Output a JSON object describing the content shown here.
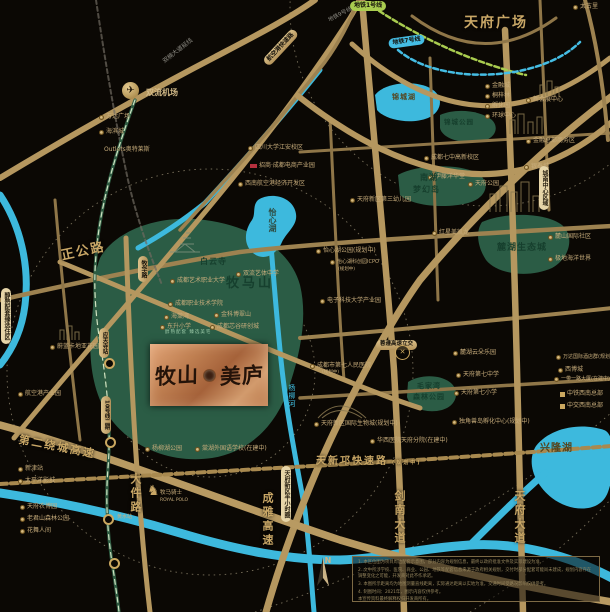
{
  "project": {
    "name_left": "牧山",
    "name_right": "美庐",
    "slogan": "醇熟配套 臻选美宅"
  },
  "colors": {
    "background": "#0b0804",
    "road_gold": "#b5975f",
    "water_cyan": "#3db9dd",
    "park_green": "#2b5c45",
    "plaque_copper": "#c08052",
    "accent_gold": "#c9a766"
  },
  "compass": {
    "letter": "N"
  },
  "disclaimer": {
    "lines": [
      "1. 本区位图为项目周边配套示意图，部分内容为规划信息，最终以政府批准文件及实际建设为准。",
      "2. 文中所涉学校、医院、商业、公园、地铁等配套信息来源于政府相关规划，交付时部分配套可能尚未建成，规划内容存在调整变化之可能，开发商对此不作承诺。",
      "3. 本图所示距离均为地图测量直线距离，实际通达距离以实地为准，交通时间受路况影响仅供参考。",
      "4. 制图时间：2021年，图示内容仅供参考。",
      "本宣传资料最终解释权归开发商所有。"
    ]
  },
  "map": {
    "labels": [
      {
        "t": "双流机场",
        "x": 146,
        "y": 89,
        "c": "p2",
        "fs": 8,
        "i": "n",
        "n": "label-shuangliu-airport"
      },
      {
        "t": "万达广场",
        "x": 99,
        "y": 114
      },
      {
        "t": "海滨城",
        "x": 99,
        "y": 129
      },
      {
        "t": "Outlets奥特莱斯",
        "x": 104,
        "y": 147,
        "i": "n"
      },
      {
        "t": "四川大学江安校区",
        "x": 248,
        "y": 145
      },
      {
        "t": "招商·成都电商产业园",
        "x": 250,
        "y": 163,
        "i": "r"
      },
      {
        "t": "西南航空港经济开发区",
        "x": 238,
        "y": 181
      },
      {
        "t": "成都七中高新校区",
        "x": 424,
        "y": 155
      },
      {
        "t": "伊藤洋华堂",
        "x": 428,
        "y": 174
      },
      {
        "t": "天府新区第三幼儿园",
        "x": 350,
        "y": 197
      },
      {
        "t": "天府公园",
        "x": 468,
        "y": 181
      },
      {
        "t": "金融城",
        "x": 485,
        "y": 83
      },
      {
        "t": "桐梓林",
        "x": 485,
        "y": 93
      },
      {
        "t": "孵化园",
        "x": 485,
        "y": 103
      },
      {
        "t": "环球中心",
        "x": 485,
        "y": 113
      },
      {
        "t": "新会展中心",
        "x": 526,
        "y": 97
      },
      {
        "t": "金融总部商务区",
        "x": 526,
        "y": 138
      },
      {
        "t": "银泰城",
        "x": 524,
        "y": 164
      },
      {
        "t": "麓山国际社区",
        "x": 548,
        "y": 234
      },
      {
        "t": "极地海洋世界",
        "x": 548,
        "y": 256
      },
      {
        "t": "红星美凯龙",
        "x": 432,
        "y": 230
      },
      {
        "t": "怡心湖公园(规划中)",
        "x": 316,
        "y": 248
      },
      {
        "t": "怡心湖科创园ICPO",
        "x": 330,
        "y": 260,
        "fs": 5
      },
      {
        "t": "(规划中)",
        "x": 338,
        "y": 268,
        "fs": 4.5,
        "i": "n"
      },
      {
        "t": "电子科技大学产业园",
        "x": 320,
        "y": 298
      },
      {
        "t": "成都市第七人民医院",
        "x": 310,
        "y": 363
      },
      {
        "t": "(规划中)",
        "x": 322,
        "y": 371,
        "fs": 4.5,
        "i": "n"
      },
      {
        "t": "麓湖云朵乐园",
        "x": 453,
        "y": 350
      },
      {
        "t": "天府第七中学",
        "x": 456,
        "y": 372
      },
      {
        "t": "天府第七小学",
        "x": 454,
        "y": 390
      },
      {
        "t": "独角兽岛孵化中心(规划中)",
        "x": 452,
        "y": 419
      },
      {
        "t": "天府新区国际生物城(规划中)",
        "x": 314,
        "y": 421
      },
      {
        "t": "华西医院天府分院(在建中)",
        "x": 370,
        "y": 438
      },
      {
        "t": "万达国际酒店群(规划中)",
        "x": 556,
        "y": 355,
        "fs": 5
      },
      {
        "t": "西博城",
        "x": 558,
        "y": 367
      },
      {
        "t": "一带一路大厦(在建中)",
        "x": 554,
        "y": 377,
        "fs": 5
      },
      {
        "t": "中铁西南总部",
        "x": 560,
        "y": 391,
        "i": "s"
      },
      {
        "t": "中交西南总部",
        "x": 560,
        "y": 403,
        "i": "s"
      },
      {
        "t": "新津站",
        "x": 18,
        "y": 466
      },
      {
        "t": "太平洋影城",
        "x": 18,
        "y": 478
      },
      {
        "t": "天府农博园",
        "x": 20,
        "y": 504
      },
      {
        "t": "老君山森林公园",
        "x": 20,
        "y": 516
      },
      {
        "t": "花舞人间",
        "x": 20,
        "y": 528
      },
      {
        "t": "蔚蓝卡地亚花园城",
        "x": 50,
        "y": 344
      },
      {
        "t": "航空港产业园",
        "x": 18,
        "y": 391
      },
      {
        "t": "成都艺术职业大学",
        "x": 170,
        "y": 278
      },
      {
        "t": "成都职业技术学院",
        "x": 168,
        "y": 301
      },
      {
        "t": "海棠湾",
        "x": 164,
        "y": 314
      },
      {
        "t": "东升小学",
        "x": 160,
        "y": 324
      },
      {
        "t": "金科博翠山",
        "x": 214,
        "y": 312
      },
      {
        "t": "成都芯谷研创城",
        "x": 210,
        "y": 324
      },
      {
        "t": "双流艺体中学",
        "x": 236,
        "y": 271
      },
      {
        "t": "杨柳湖公园",
        "x": 145,
        "y": 446
      },
      {
        "t": "棠湖外国语学校(在建中)",
        "x": 195,
        "y": 446
      },
      {
        "t": "太古里",
        "x": 573,
        "y": 4
      },
      {
        "t": "黄水站",
        "x": 117,
        "y": 515,
        "fs": 5,
        "i": "n"
      },
      {
        "t": "牧马骑士",
        "x": 160,
        "y": 491,
        "fs": 5.5,
        "i": "n"
      },
      {
        "t": "ROYAL POLO",
        "x": 160,
        "y": 499,
        "fs": 4.5,
        "i": "n"
      },
      {
        "t": "天府广场",
        "x": 464,
        "y": 16,
        "c": "rl",
        "fs": 14,
        "n": "label-tianfu-square"
      },
      {
        "t": "正公路",
        "x": 60,
        "y": 250,
        "c": "rl",
        "fs": 13,
        "r": -12,
        "n": "label-zhenggong-road"
      },
      {
        "t": "第二绕城高速",
        "x": 20,
        "y": 434,
        "c": "rl",
        "fs": 11,
        "r": 11
      },
      {
        "t": "大件路",
        "x": 130,
        "y": 473,
        "c": "rv",
        "fs": 11
      },
      {
        "t": "成雅高速",
        "x": 262,
        "y": 492,
        "c": "rv",
        "fs": 11
      },
      {
        "t": "剑南大道",
        "x": 394,
        "y": 490,
        "c": "rv",
        "fs": 11
      },
      {
        "t": "天府大道",
        "x": 514,
        "y": 490,
        "c": "rv",
        "fs": 11
      },
      {
        "t": "天新邛快速路",
        "x": 316,
        "y": 457,
        "c": "rl",
        "fs": 10
      },
      {
        "t": "(规划中)",
        "x": 392,
        "y": 461,
        "c": "rl",
        "fs": 5
      },
      {
        "t": "牧马山",
        "x": 226,
        "y": 277,
        "c": "al",
        "fs": 13,
        "n": "label-muma-mountain"
      },
      {
        "t": "白云寺",
        "x": 200,
        "y": 258,
        "c": "am",
        "fs": 8
      },
      {
        "t": "麓湖生态城",
        "x": 497,
        "y": 244,
        "c": "am",
        "fs": 9
      },
      {
        "t": "南湖",
        "x": 420,
        "y": 174,
        "c": "am",
        "fs": 8
      },
      {
        "t": "梦幻岛",
        "x": 413,
        "y": 186,
        "c": "am",
        "fs": 8
      },
      {
        "t": "毛家湾",
        "x": 417,
        "y": 383,
        "c": "am",
        "fs": 7
      },
      {
        "t": "森林公园",
        "x": 413,
        "y": 394,
        "c": "am",
        "fs": 7
      },
      {
        "t": "锦城公园",
        "x": 444,
        "y": 119,
        "c": "am",
        "fs": 6.5
      },
      {
        "t": "锦城湖",
        "x": 392,
        "y": 94,
        "c": "w",
        "fs": 7
      },
      {
        "t": "怡心湖",
        "x": 268,
        "y": 208,
        "c": "wv2",
        "fs": 8
      },
      {
        "t": "兴隆湖",
        "x": 540,
        "y": 444,
        "c": "w",
        "fs": 10,
        "n": "label-xinglong-lake"
      },
      {
        "t": "杨柳河",
        "x": 288,
        "y": 384,
        "c": "wv",
        "fs": 7
      },
      {
        "t": "地铁1号线",
        "x": 350,
        "y": 1,
        "c": "pg",
        "n": "pill-metro-line1"
      },
      {
        "t": "地铁7号线",
        "x": 388,
        "y": 39,
        "c": "pc",
        "r": -8,
        "n": "pill-metro-line7"
      },
      {
        "t": "地铁9号线",
        "x": 328,
        "y": 19,
        "c": "g",
        "r": -28,
        "fs": 5.5
      },
      {
        "t": "双楠大道延线",
        "x": 162,
        "y": 60,
        "c": "g",
        "r": -38,
        "fs": 6
      },
      {
        "t": "航空港快速路",
        "x": 262,
        "y": 60,
        "c": "ph",
        "r": -47,
        "fs": 6
      },
      {
        "t": "牧华路",
        "x": 138,
        "y": 256,
        "c": "pv",
        "fs": 6
      },
      {
        "t": "应天寺站",
        "x": 99,
        "y": 328,
        "c": "pv",
        "fs": 5.5
      },
      {
        "t": "10号线二期",
        "x": 101,
        "y": 396,
        "c": "pv",
        "fs": 5.5
      },
      {
        "t": "蓉遵高速立交",
        "x": 376,
        "y": 340,
        "c": "ph",
        "fs": 5.5
      },
      {
        "t": "醇熟配套臻选住区",
        "x": 1,
        "y": 288,
        "c": "pk",
        "fs": 6
      },
      {
        "t": "天府新区半小时圈",
        "x": 281,
        "y": 466,
        "c": "pk",
        "fs": 6
      },
      {
        "t": "城南中心区域",
        "x": 539,
        "y": 166,
        "c": "pk",
        "fs": 6
      },
      {
        "t": "醇熟配套 臻选美宅",
        "x": 165,
        "y": 331,
        "c": "gn",
        "fs": 4.5
      }
    ],
    "icons": [
      {
        "k": "plane",
        "x": 122,
        "y": 82,
        "n": "airplane-icon"
      },
      {
        "k": "horse",
        "x": 147,
        "y": 484,
        "n": "polo-horse-icon"
      },
      {
        "k": "interchange",
        "x": 395,
        "y": 345,
        "n": "interchange-icon"
      },
      {
        "k": "station",
        "x": 104,
        "y": 358,
        "n": "metro-station-icon"
      },
      {
        "k": "station",
        "x": 105,
        "y": 437,
        "n": "metro-station-icon"
      },
      {
        "k": "station",
        "x": 103,
        "y": 514,
        "n": "metro-station-icon"
      },
      {
        "k": "station",
        "x": 109,
        "y": 558,
        "n": "metro-station-icon"
      }
    ]
  }
}
